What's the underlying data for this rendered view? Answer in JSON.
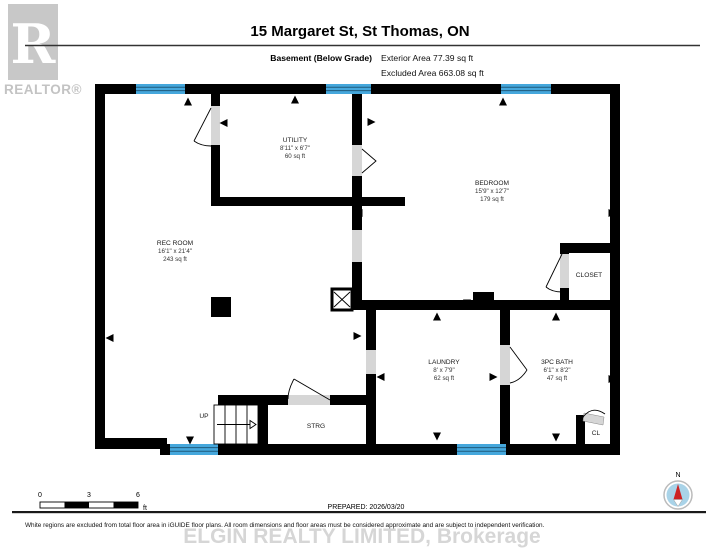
{
  "header": {
    "title": "15 Margaret St, St Thomas, ON",
    "floor_label": "Basement (Below Grade)",
    "exterior_area": "Exterior Area 77.39 sq ft",
    "excluded_area": "Excluded Area 663.08 sq ft"
  },
  "logo": {
    "letter": "R",
    "realtor_text": "REALTOR®"
  },
  "rooms": {
    "rec_room": {
      "name": "REC ROOM",
      "dims": "16'1\" x 21'4\"",
      "area": "243 sq ft"
    },
    "utility": {
      "name": "UTILITY",
      "dims": "8'11\" x 6'7\"",
      "area": "60 sq ft"
    },
    "bedroom": {
      "name": "BEDROOM",
      "dims": "15'9\" x 12'7\"",
      "area": "179 sq ft"
    },
    "laundry": {
      "name": "LAUNDRY",
      "dims": "8' x 7'9\"",
      "area": "62 sq ft"
    },
    "bath": {
      "name": "3PC BATH",
      "dims": "6'1\" x 8'2\"",
      "area": "47 sq ft"
    },
    "closet": {
      "name": "CLOSET"
    },
    "storage": {
      "name": "STRG"
    },
    "cl": {
      "name": "CL"
    },
    "stairs": {
      "label": "UP"
    }
  },
  "scale_bar": {
    "tick0": "0",
    "tick3": "3",
    "tick6": "6",
    "unit": "ft"
  },
  "prepared": "PREPARED: 2026/03/20",
  "compass": {
    "label": "N"
  },
  "footer": {
    "disclaimer": "White regions are excluded from total floor area in iGUIDE floor plans. All room dimensions and floor areas must be considered approximate and are subject to independent verification.",
    "watermark": "ELGIN REALTY LIMITED, Brokerage"
  },
  "colors": {
    "wall_black": "#000000",
    "window_blue": "#45a7dc",
    "door_gray": "#d6d6d6",
    "logo_gray": "#c8c8c8",
    "watermark_gray": "#d6d6d6",
    "compass_blue": "#a9d3e8",
    "compass_red": "#cc2222"
  }
}
